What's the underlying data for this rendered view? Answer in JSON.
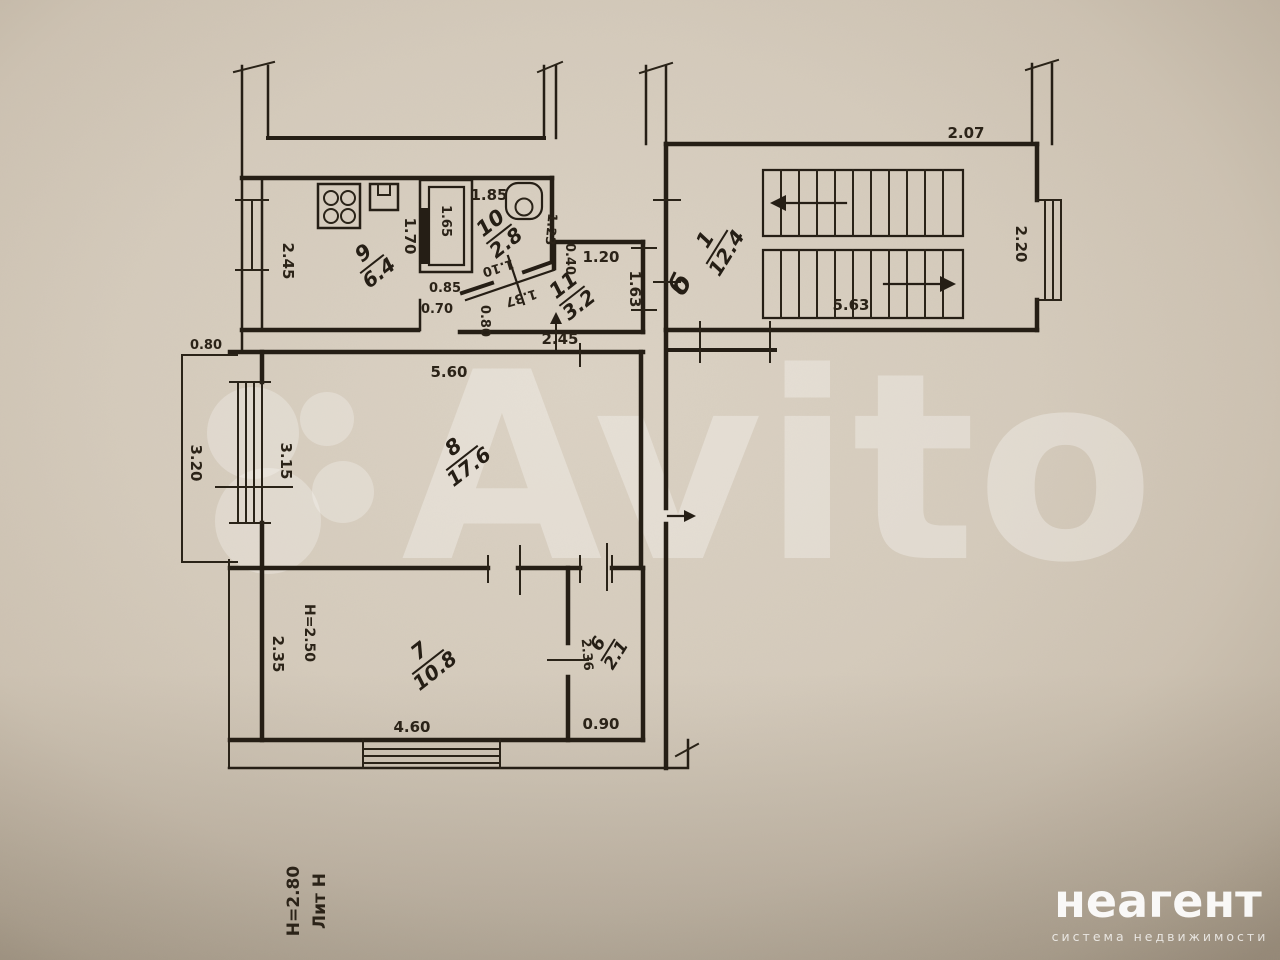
{
  "watermark": {
    "brand": "Avito",
    "agency": "неагент",
    "agency_subtitle": "система недвижимости"
  },
  "title_block": {
    "liter": "Лит Н",
    "building_height": "Н=2.80"
  },
  "annotations": {
    "section_letter": "б",
    "room7_ceiling_height": "Н=2.50"
  },
  "rooms": [
    {
      "id": "stairwell",
      "num": "1",
      "area": "12.4"
    },
    {
      "id": "hall-6",
      "num": "6",
      "area": "2.1"
    },
    {
      "id": "room-7",
      "num": "7",
      "area": "10.8"
    },
    {
      "id": "room-8",
      "num": "8",
      "area": "17.6"
    },
    {
      "id": "kitchen-9",
      "num": "9",
      "area": "6.4"
    },
    {
      "id": "bath-10",
      "num": "10",
      "area": "2.8"
    },
    {
      "id": "hall-11",
      "num": "11",
      "area": "3.2"
    }
  ],
  "dimensions": {
    "stair_top_width": "2.07",
    "stair_side": "2.20",
    "stair_flight": "5.63",
    "kitchen_width": "2.45",
    "kitchen_wall": "1.70",
    "duct_height": "1.65",
    "duct_width": "0.85",
    "bath_width": "1.85",
    "bath_side": "1.23",
    "bath_door_a": "1.10",
    "bath_door_b": "1.37",
    "hall_jog": "0.40",
    "hall11_width": "1.20",
    "hall11_door": "1.63",
    "kitchen_door": "0.70",
    "hall_pass": "0.80",
    "hall_width": "2.45",
    "room8_width": "5.60",
    "balcony_width": "0.80",
    "balcony_length": "3.20",
    "room8_window": "3.15",
    "room7_side": "2.35",
    "room7_width": "4.60",
    "hall6_side": "2.36",
    "hall6_door": "0.90"
  },
  "colors": {
    "paper": "#d5cbbc",
    "ink": "#251e15",
    "watermark": "#ffffff"
  }
}
